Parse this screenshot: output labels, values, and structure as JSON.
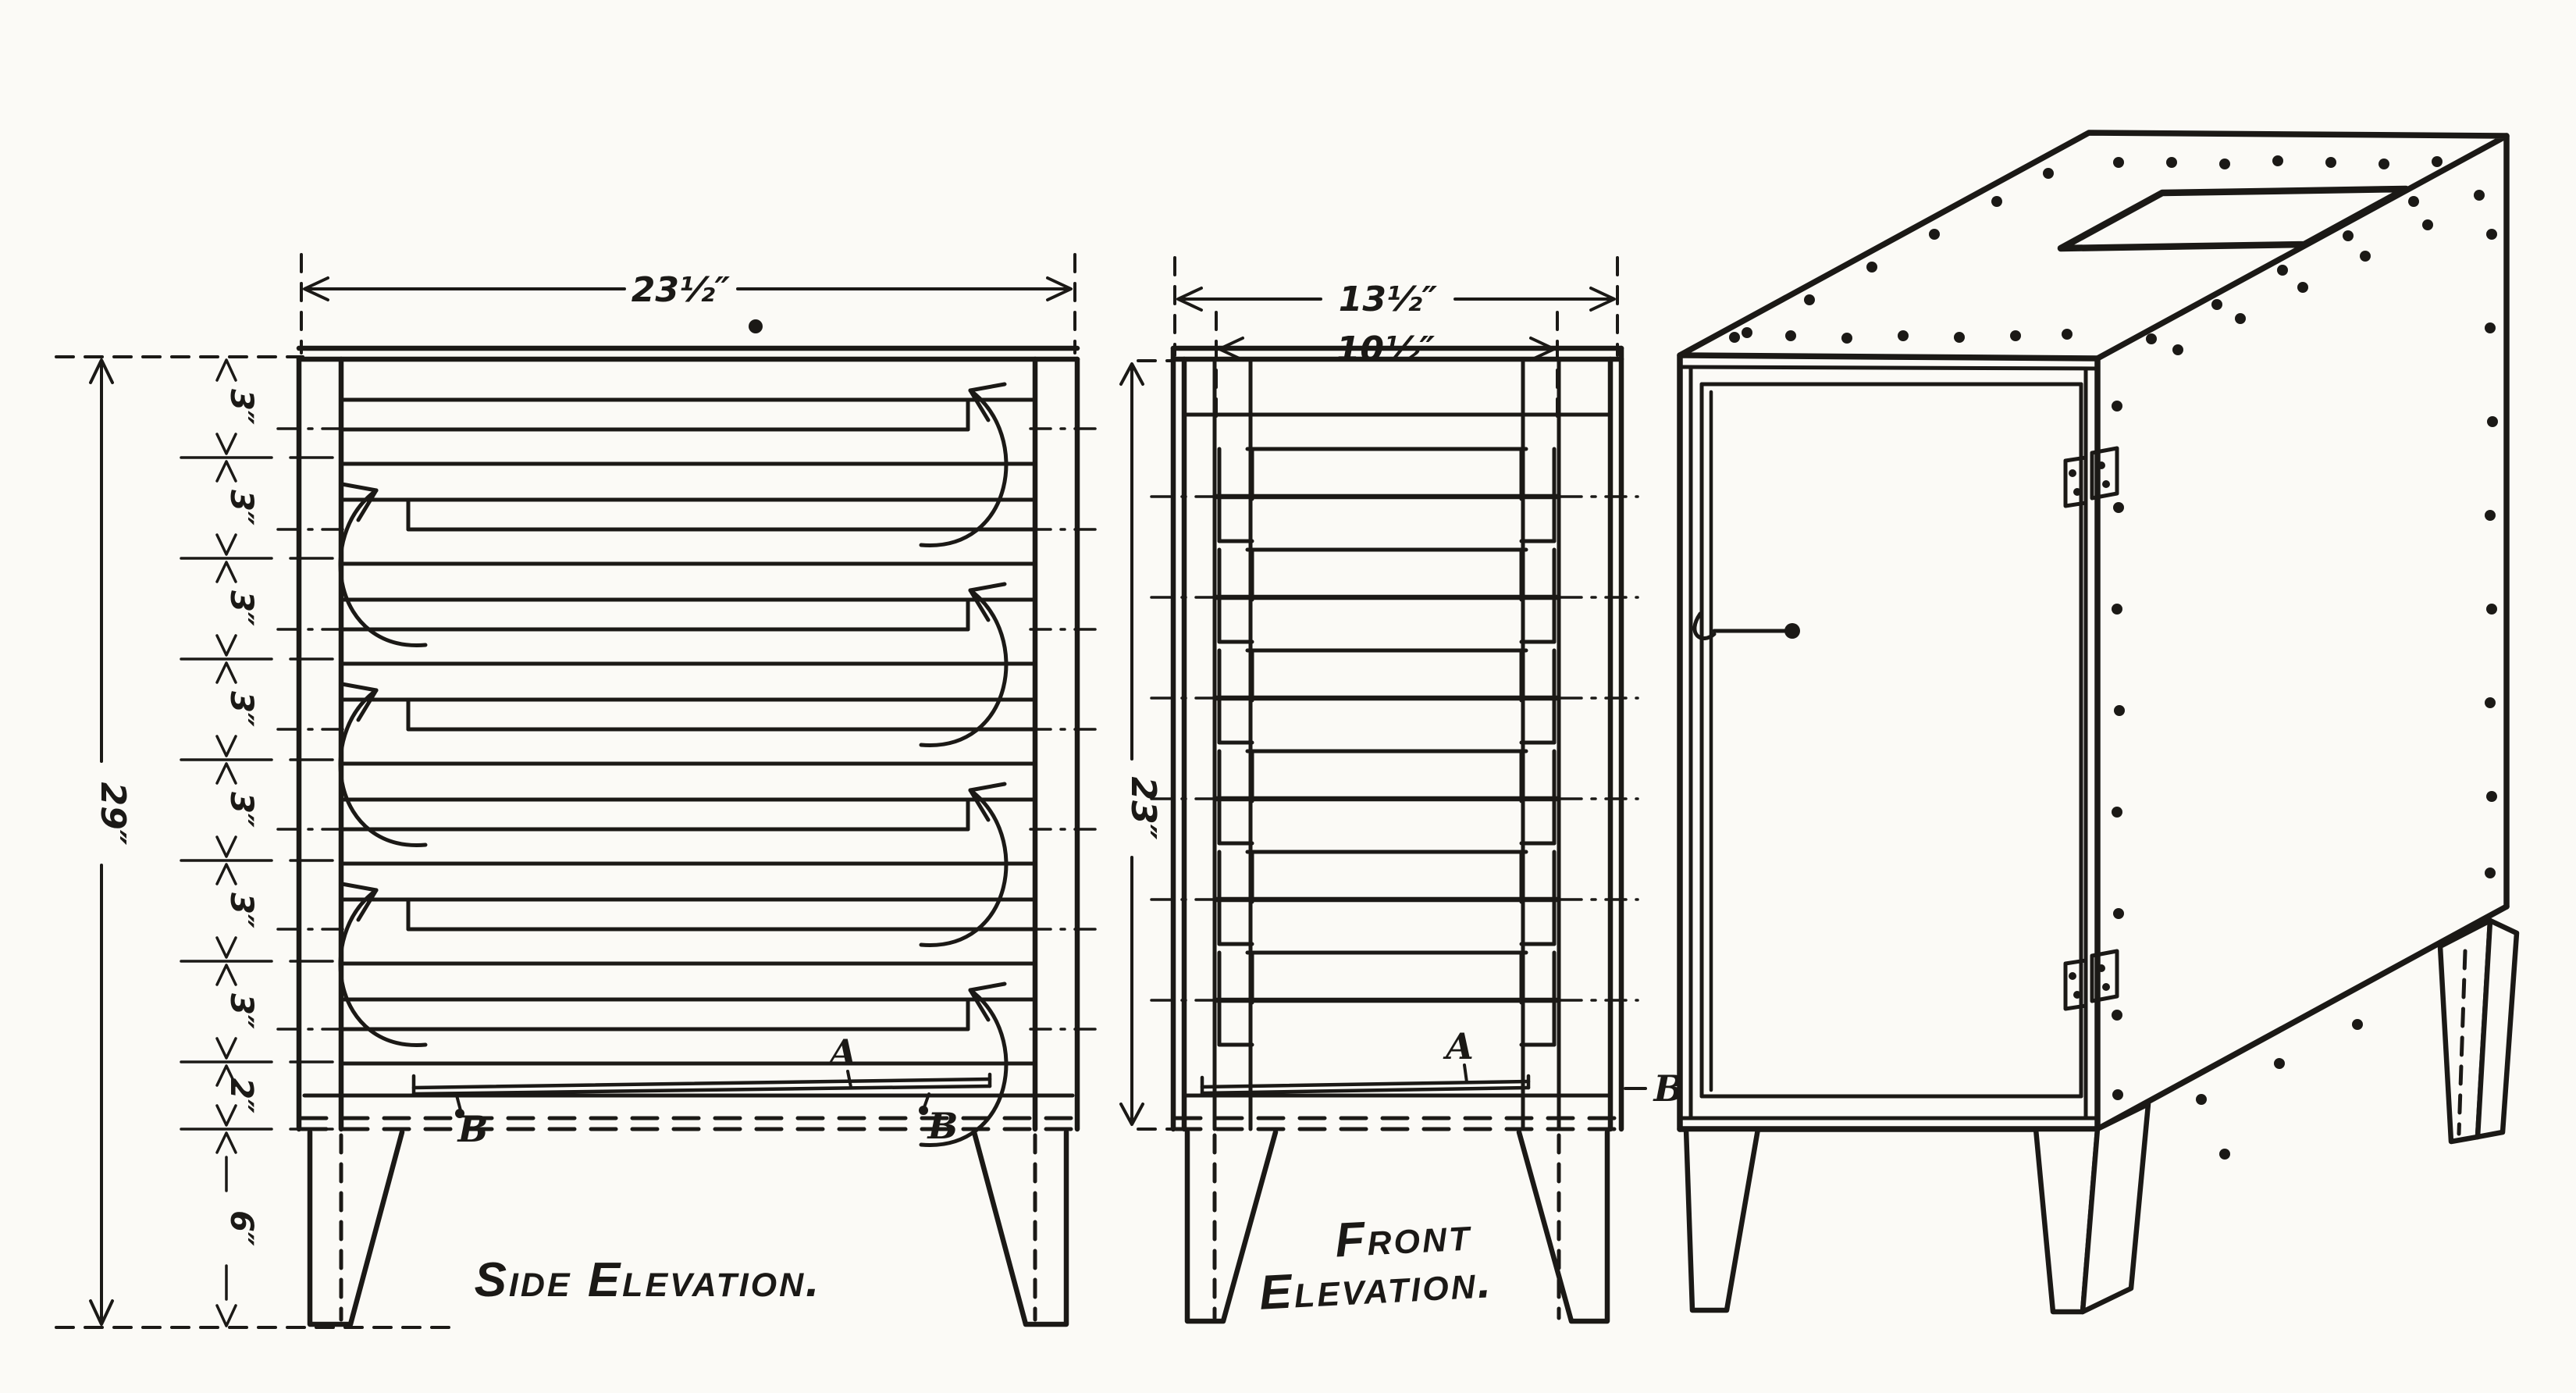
{
  "drawing": {
    "side": {
      "title": "Side Elevation.",
      "width_dim": "23½″",
      "height_dim": "29″",
      "chain": [
        "3″",
        "3″",
        "3″",
        "3″",
        "3″",
        "3″",
        "3″",
        "2″",
        "6″"
      ],
      "tray_label": "A",
      "hook_label_left": "B",
      "hook_label_right": "B"
    },
    "front": {
      "title_line1": "Front",
      "title_line2": "Elevation.",
      "width_dim": "13½″",
      "inner_width_dim": "10½″",
      "height_dim": "23″",
      "tray_label": "A",
      "hook_label": "B"
    },
    "colors": {
      "ink": "#1b1916",
      "paper": "#fbfaf6"
    }
  }
}
